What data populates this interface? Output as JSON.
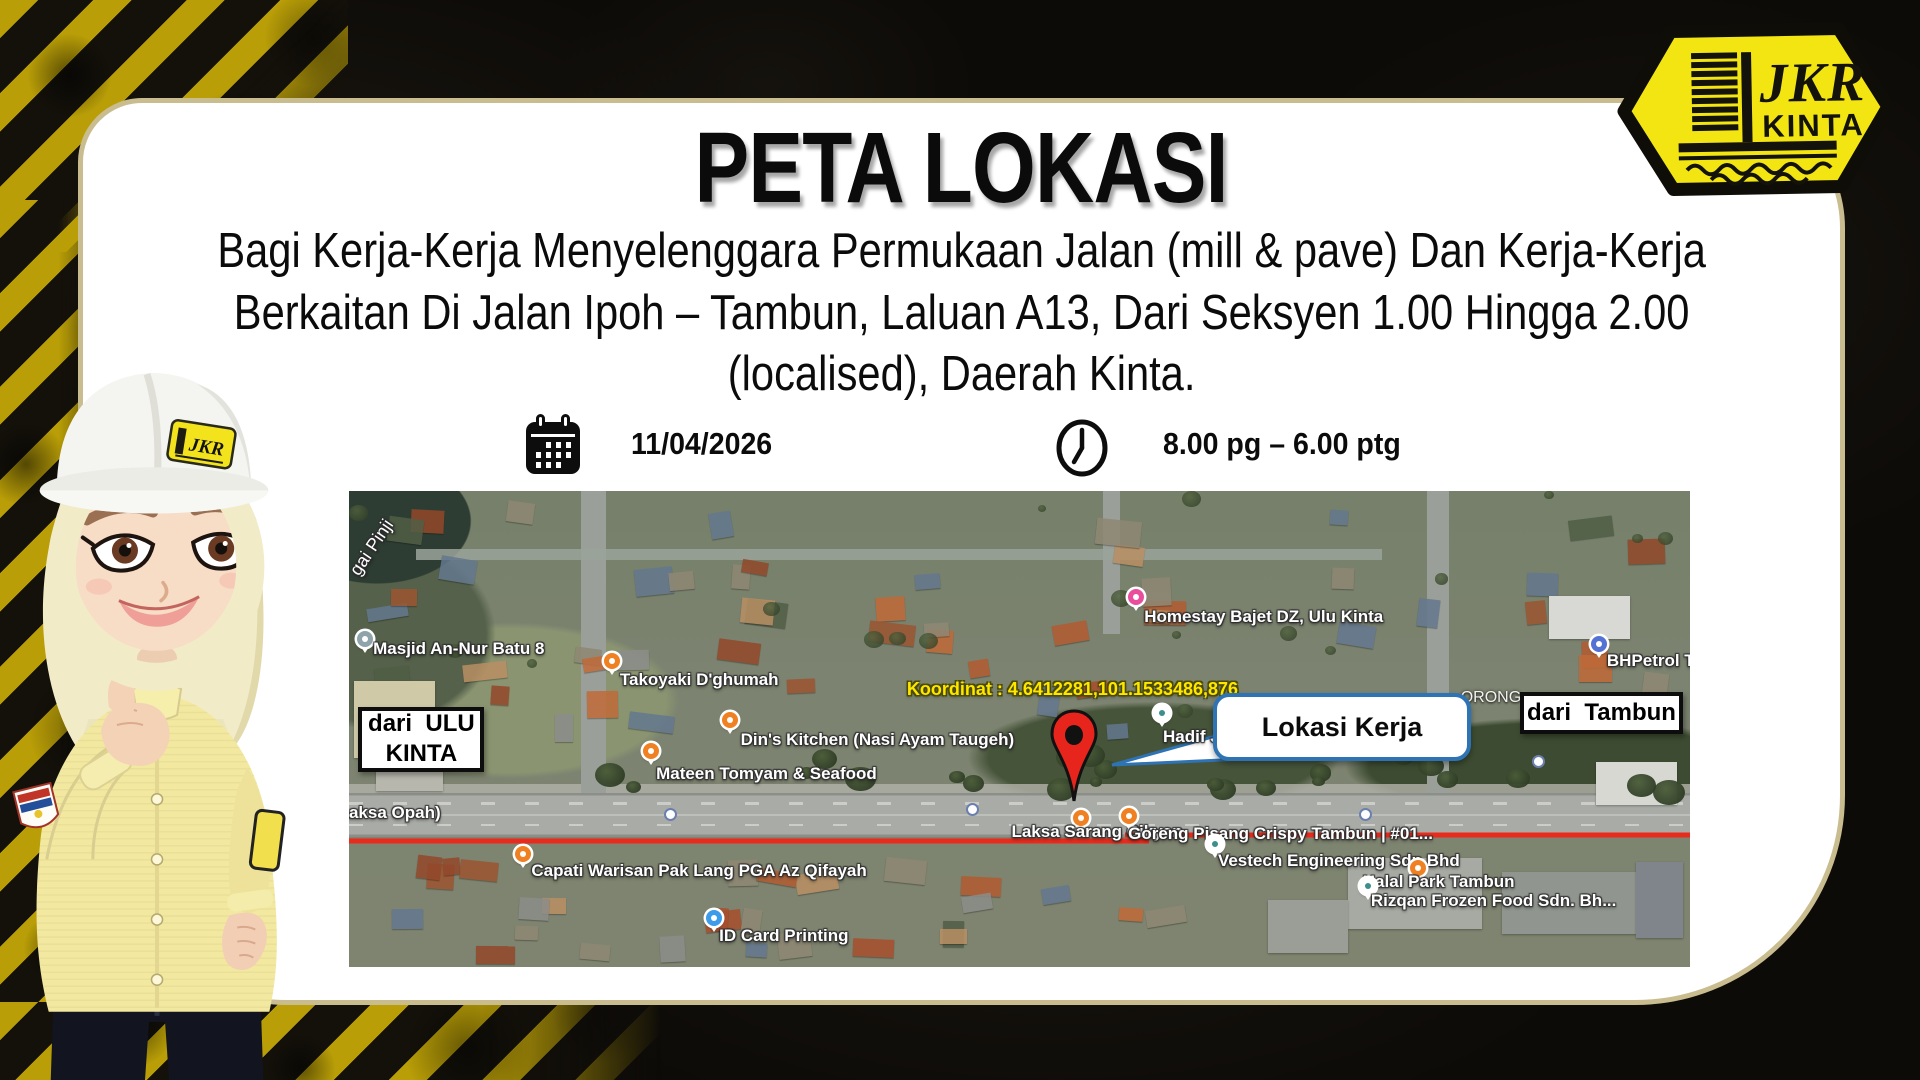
{
  "logo": {
    "jkr": "JKR",
    "kinta": "KINTA"
  },
  "title": "PETA LOKASI",
  "subtitle": {
    "lines": [
      "Bagi Kerja-Kerja Menyelenggara Permukaan Jalan (mill & pave) Dan Kerja-Kerja",
      "Berkaitan Di Jalan Ipoh – Tambun, Laluan A13, Dari Seksyen 1.00 Hingga 2.00",
      "(localised), Daerah Kinta."
    ]
  },
  "schedule": {
    "date": "11/04/2026",
    "time": "8.00 pg – 6.00 ptg"
  },
  "map": {
    "coordinate_label": "Koordinat : 4.6412281,101.1533486,876",
    "callout_label": "Lokasi Kerja",
    "from_left": {
      "line1": "dari  ULU",
      "line2": "KINTA"
    },
    "from_right": "dari  Tambun",
    "places": [
      {
        "id": "masjid",
        "label": "Masjid An-Nur Batu 8",
        "type": "mosque",
        "pin": [
          0.6,
          29.5
        ],
        "text": [
          1.8,
          31.2
        ]
      },
      {
        "id": "takoyaki",
        "label": "Takoyaki D'ghumah",
        "type": "food",
        "pin": [
          19.0,
          34.0
        ],
        "text": [
          20.2,
          37.8
        ]
      },
      {
        "id": "dins-kitchen",
        "label": "Din's Kitchen (Nasi Ayam Taugeh)",
        "type": "food",
        "pin": [
          27.8,
          46.5
        ],
        "text": [
          29.2,
          50.5
        ]
      },
      {
        "id": "mateen",
        "label": "Mateen Tomyam & Seafood",
        "type": "food",
        "pin": [
          21.9,
          53.0
        ],
        "text": [
          22.9,
          57.5
        ]
      },
      {
        "id": "laksa-opah",
        "label": "(Laksa Opah)",
        "type": "plain",
        "text": [
          -1.2,
          65.8
        ]
      },
      {
        "id": "homestay",
        "label": "Homestay Bajet DZ, Ulu Kinta",
        "type": "lodging",
        "pin": [
          58.1,
          20.5
        ],
        "text": [
          59.3,
          24.5
        ]
      },
      {
        "id": "hadif",
        "label": "Hadif Ja",
        "type": "poi",
        "pin": [
          60.0,
          45.0
        ],
        "text": [
          60.7,
          49.8
        ]
      },
      {
        "id": "bhpetrol",
        "label": "BHPetrol Tam",
        "type": "fuel",
        "pin": [
          92.6,
          30.5
        ],
        "text": [
          93.8,
          33.8
        ]
      },
      {
        "id": "capati",
        "label": "Capati Warisan Pak Lang PGA Az Qifayah",
        "type": "food",
        "pin": [
          12.4,
          74.5
        ],
        "text": [
          13.6,
          78.0
        ]
      },
      {
        "id": "id-card",
        "label": "ID Card Printing",
        "type": "lock",
        "pin": [
          26.6,
          88.0
        ],
        "text": [
          27.6,
          91.5
        ]
      },
      {
        "id": "laksa-sarang",
        "label": "Laksa Sarang Cikyan",
        "type": "food",
        "pin": [
          54.0,
          67.0
        ],
        "text": [
          49.4,
          69.8
        ]
      },
      {
        "id": "goreng-pisang",
        "label": "Goreng Pisang Crispy Tambun | #01...",
        "type": "food",
        "pin": [
          57.6,
          66.6
        ],
        "text": [
          58.1,
          70.2
        ]
      },
      {
        "id": "vestech",
        "label": "Vestech Engineering Sdn Bhd",
        "type": "poi",
        "pin": [
          64.0,
          72.5
        ],
        "text": [
          64.8,
          75.8
        ]
      },
      {
        "id": "halal-park",
        "label": "Halal Park Tambun",
        "type": "food",
        "pin": [
          79.1,
          77.5
        ],
        "text": [
          75.6,
          80.2
        ]
      },
      {
        "id": "rizqan",
        "label": "Rizqan Frozen Food Sdn. Bh...",
        "type": "poi",
        "pin": [
          75.4,
          81.2
        ],
        "text": [
          76.2,
          84.2
        ]
      },
      {
        "id": "lorong",
        "label": "ORONG",
        "type": "street",
        "text": [
          82.9,
          41.8
        ]
      },
      {
        "id": "sungai-pinji",
        "label": "gai Pinji",
        "type": "river",
        "text": [
          1.0,
          14.5
        ],
        "rot": -56
      }
    ]
  },
  "colors": {
    "badge_yellow": "#f3e512",
    "card_border": "#c9bd8f",
    "hazard_yellow": "#b99e07",
    "red_line": "#e92a1c",
    "pin_red": "#e8251d",
    "callout_border": "#2e74b5",
    "coordinate_yellow": "#ffe600"
  }
}
